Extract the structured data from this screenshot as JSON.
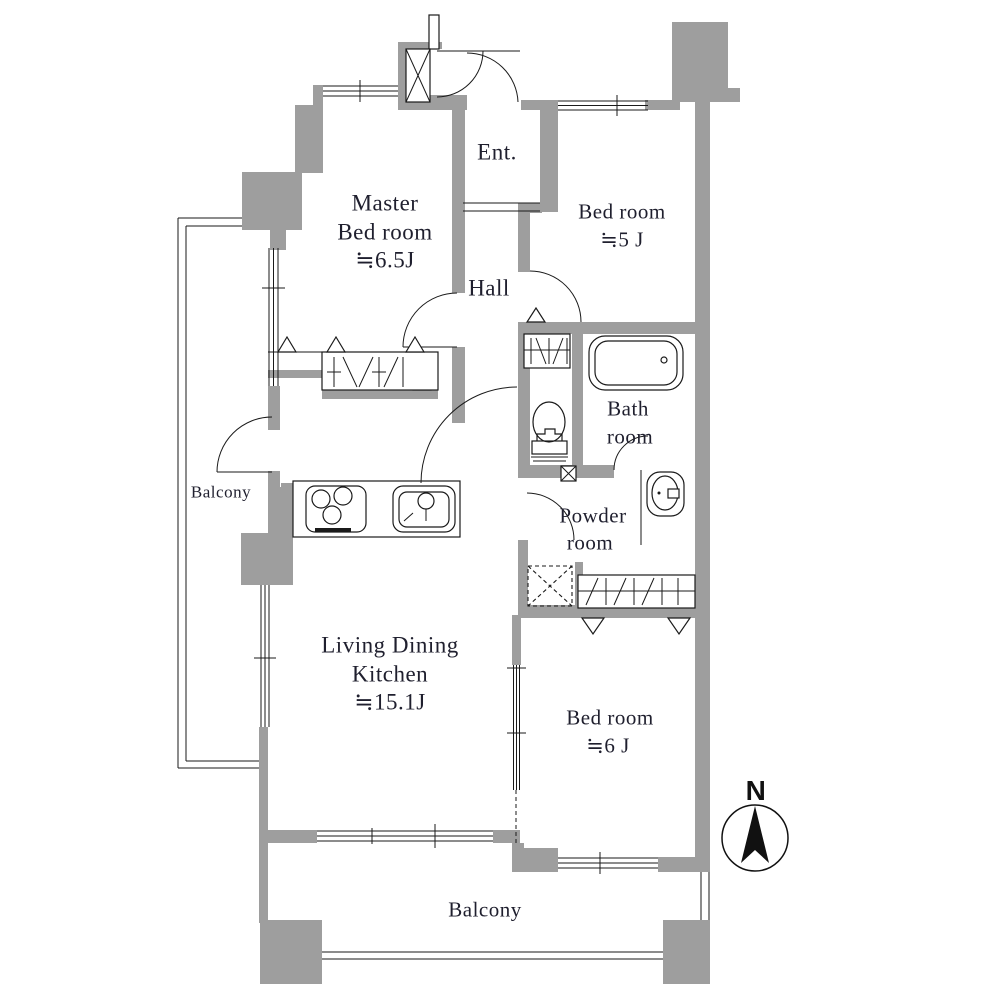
{
  "floor_plan": {
    "rooms": {
      "master_bedroom": {
        "line1": "Master",
        "line2": "Bed room",
        "area": "≒6.5J"
      },
      "bedroom_top_right": {
        "name": "Bed room",
        "area": "≒5 J"
      },
      "entrance": {
        "name": "Ent."
      },
      "hall": {
        "name": "Hall"
      },
      "bathroom": {
        "line1": "Bath",
        "line2": "room"
      },
      "powder_room": {
        "line1": "Powder",
        "line2": "room"
      },
      "living_dining_kitchen": {
        "line1": "Living Dining",
        "line2": "Kitchen",
        "area": "≒15.1J"
      },
      "bedroom_bottom_right": {
        "name": "Bed room",
        "area": "≒6 J"
      },
      "balcony_left": {
        "name": "Balcony"
      },
      "balcony_bottom": {
        "name": "Balcony"
      }
    },
    "compass": {
      "north_label": "N"
    },
    "colors": {
      "wall_fill": "#9e9e9e",
      "line": "#1a1a1a",
      "label_text": "#1f1f2e",
      "background": "#ffffff"
    }
  }
}
